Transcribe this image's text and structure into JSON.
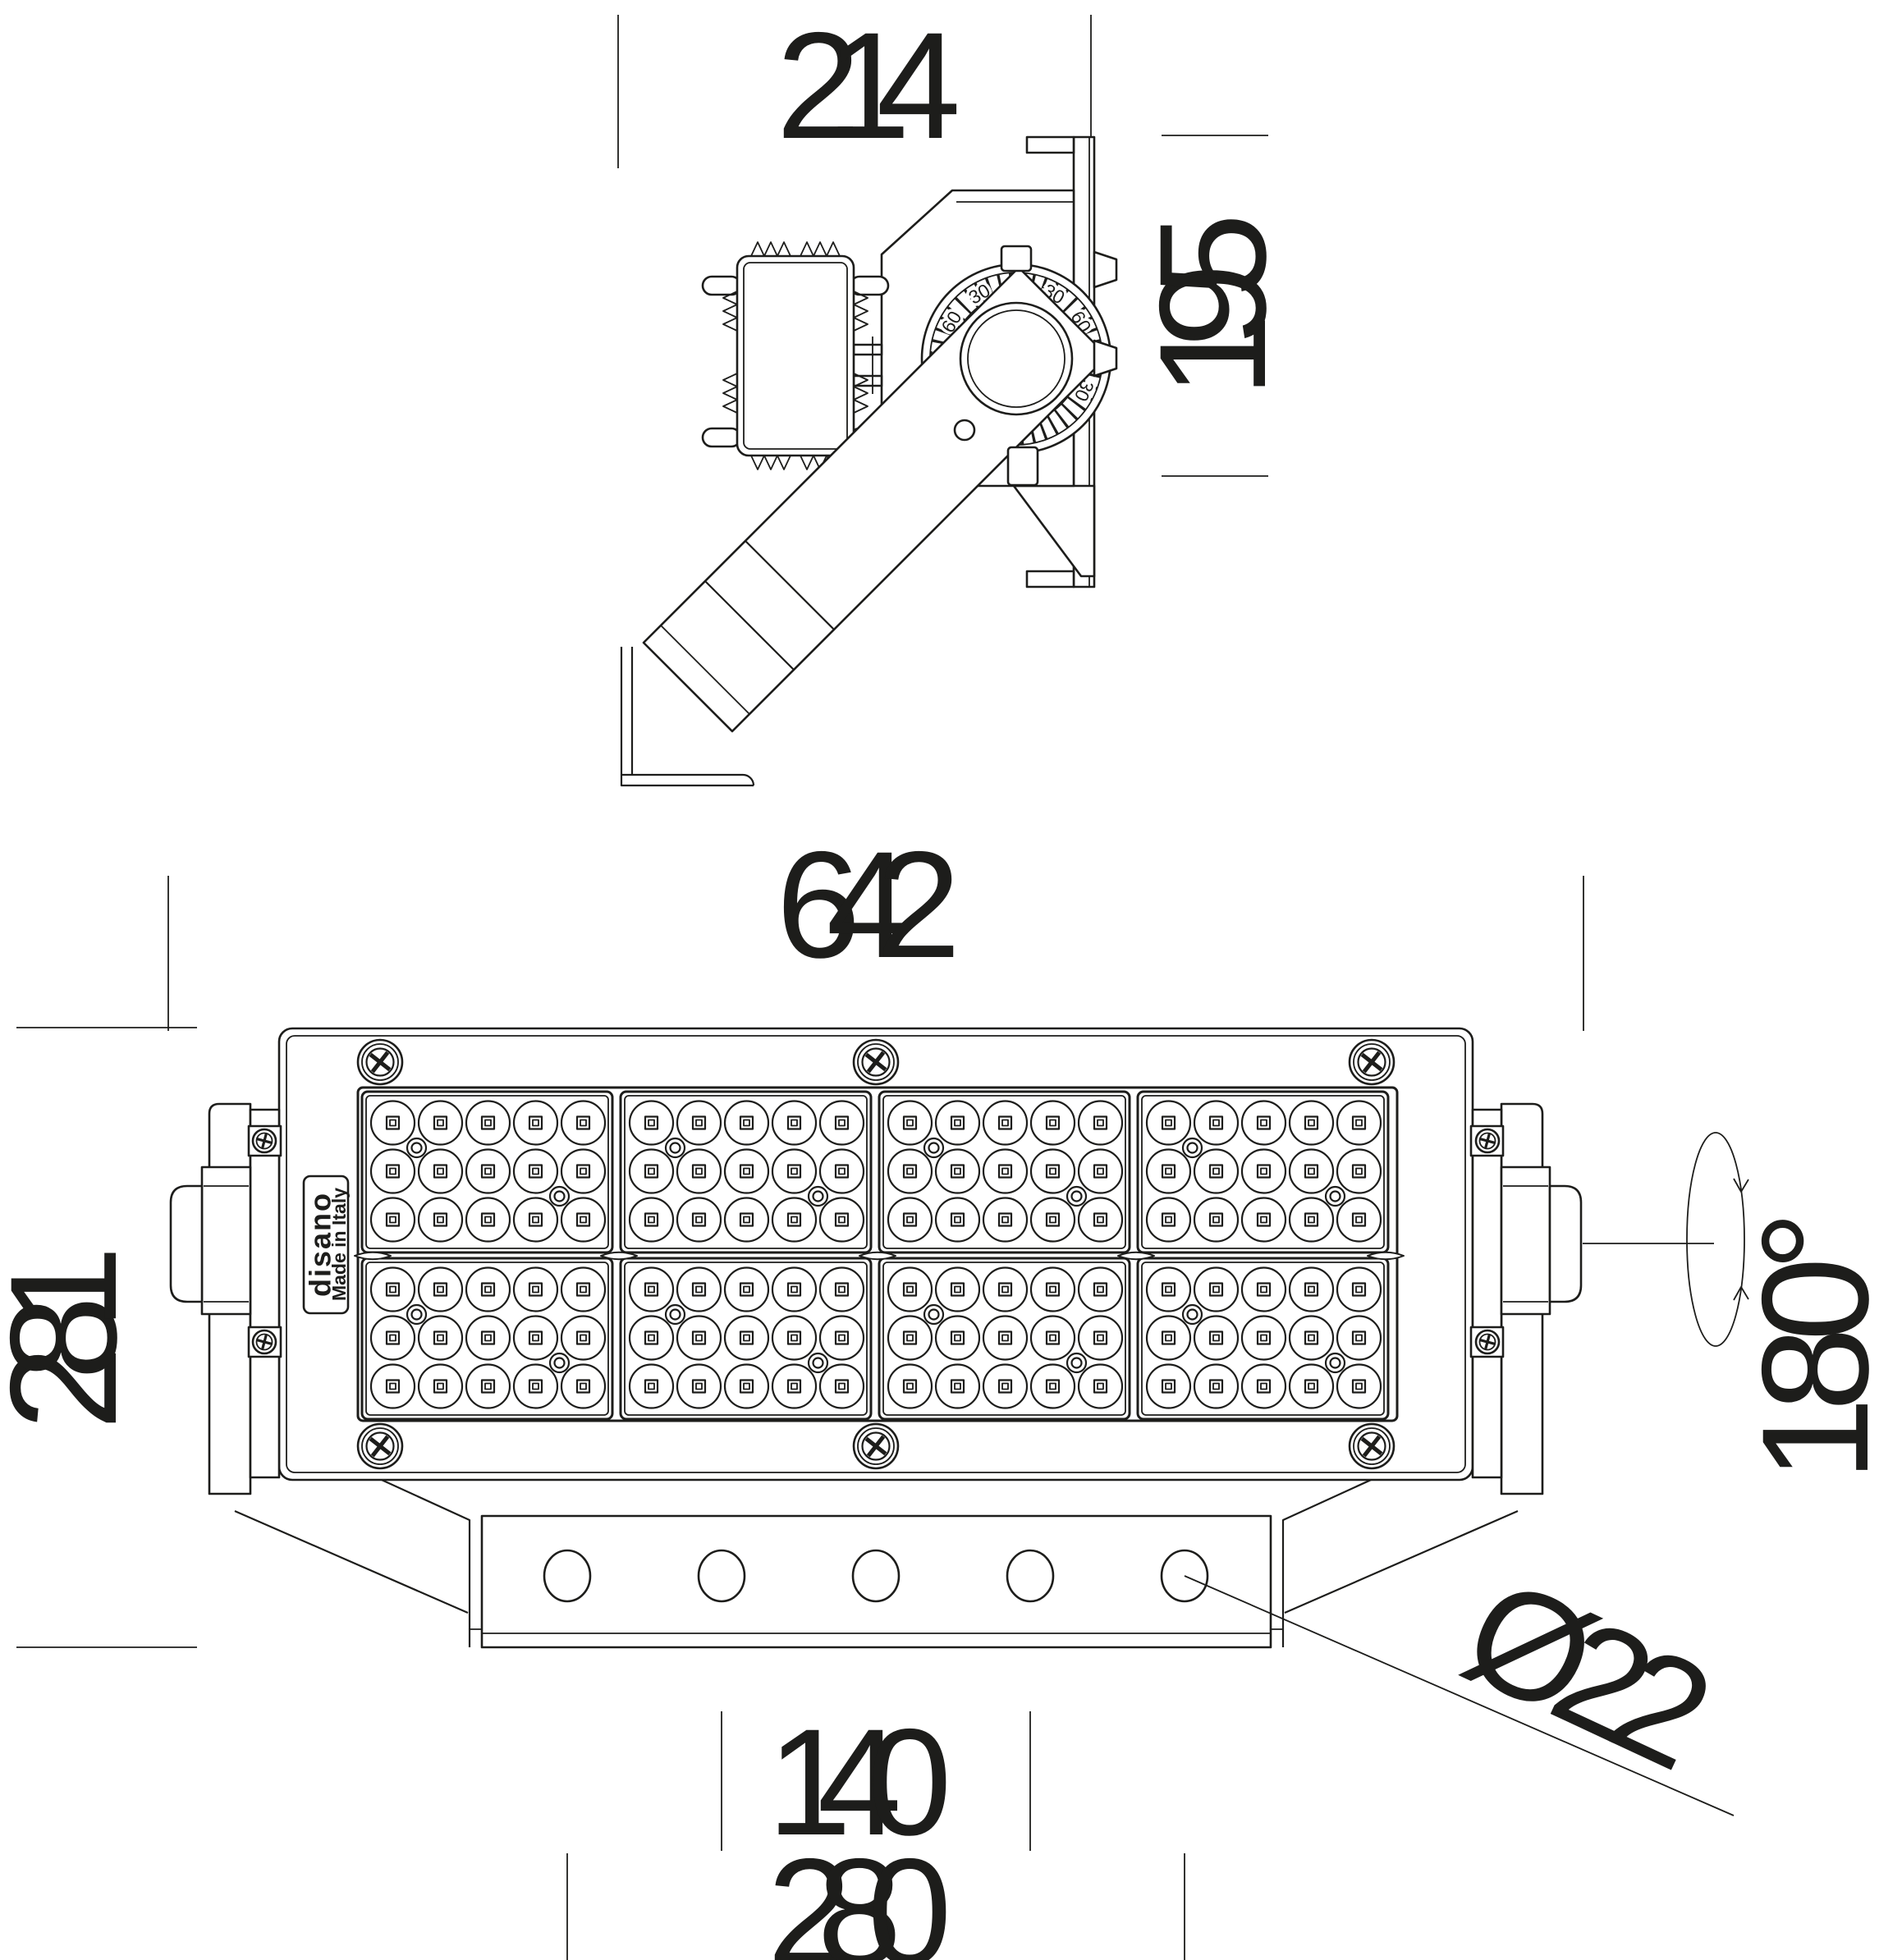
{
  "doc": {
    "kind": "floodlight dimensional line drawing",
    "ink_color": "#1d1d1b",
    "background_color": "#ffffff"
  },
  "side_view": {
    "depth_mm": "214",
    "height_mm": "195",
    "dial_scale": [
      "90",
      "60",
      "30",
      "30",
      "60",
      "90",
      "60",
      "30"
    ]
  },
  "front_view": {
    "width_mm": "642",
    "height_mm": "281",
    "hole_pitch_mm": "140",
    "hole_span_mm": "280",
    "hole_diameter": "Ø22",
    "rotation_range": "180°",
    "label": {
      "brand": "disano",
      "made_in": "Made in Italy"
    }
  }
}
